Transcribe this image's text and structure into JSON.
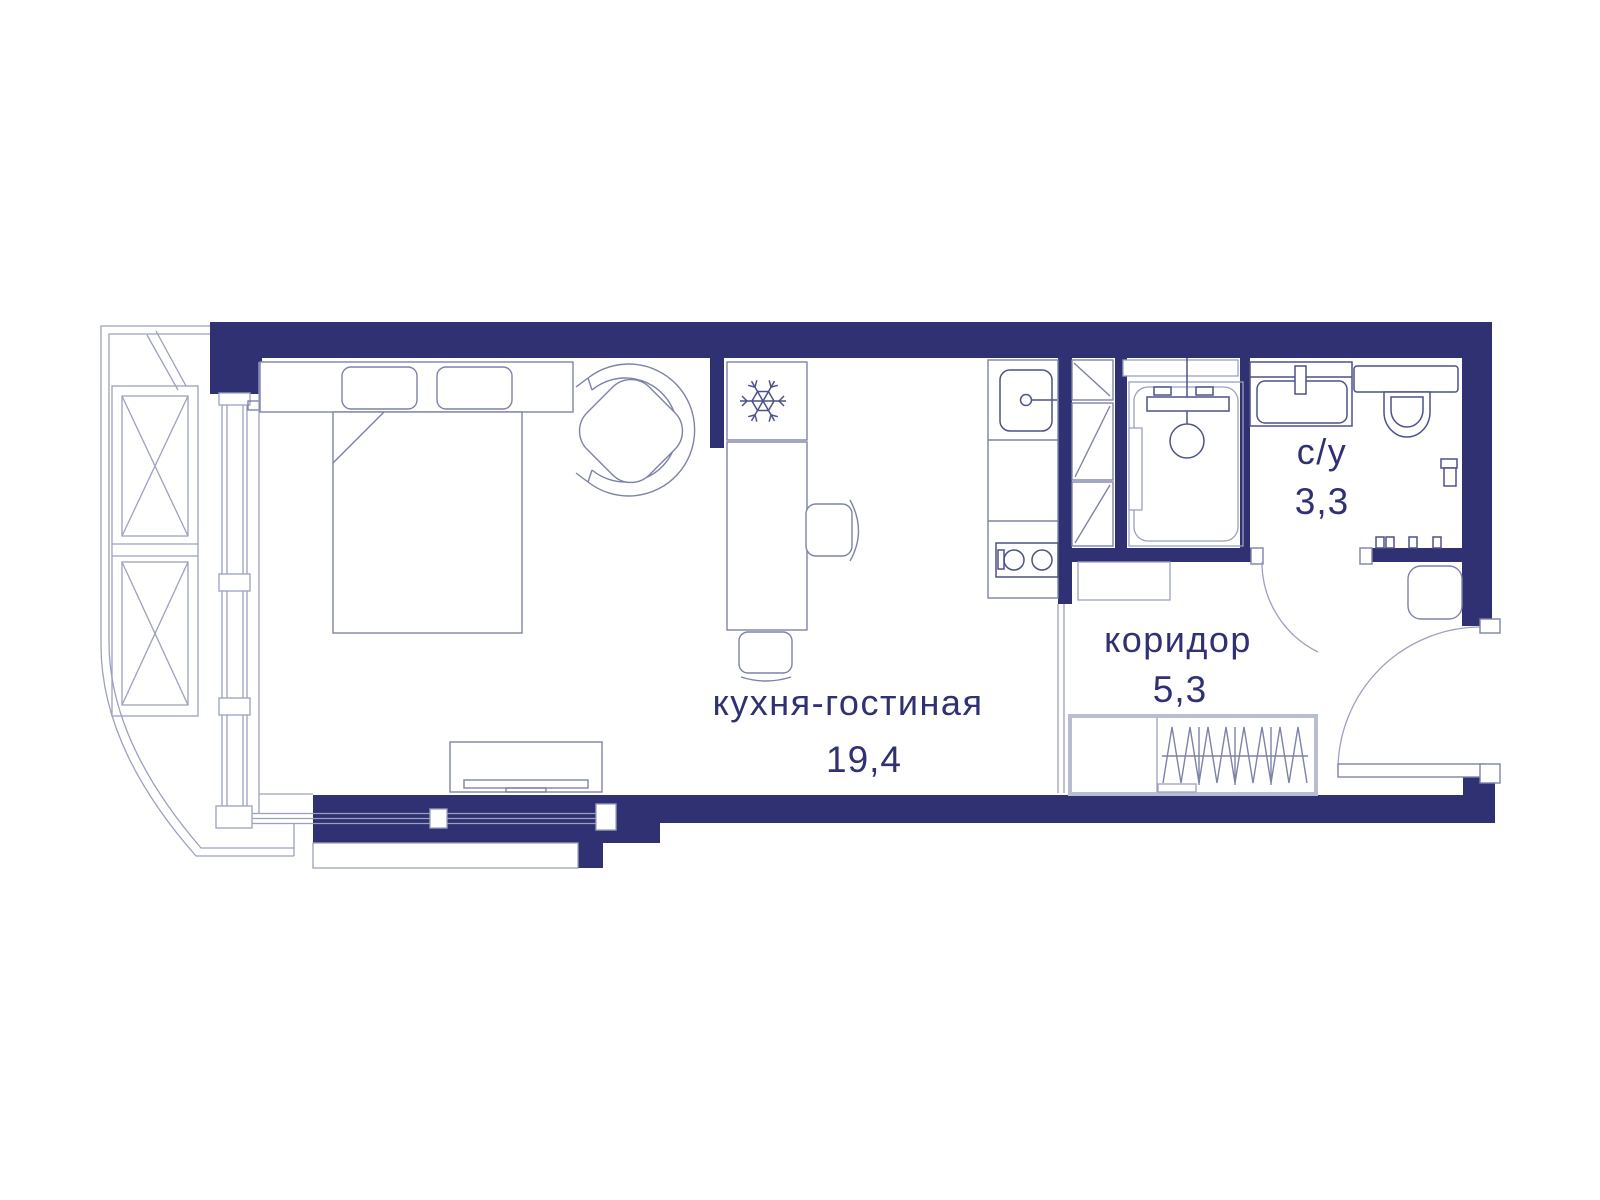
{
  "plan": {
    "title": "studio apartment floor plan",
    "rooms": [
      {
        "name": "кухня-гостиная",
        "area": "19,4"
      },
      {
        "name": "коридор",
        "area": "5,3"
      },
      {
        "name": "с/у",
        "area": "3,3"
      }
    ],
    "colors": {
      "wall": "#2f3172",
      "text": "#2f3172",
      "line_light": "#9ba0bf",
      "line_mid": "#7d82a8",
      "fixture": "#4d5288",
      "wardrobe": "#b9bdd2",
      "bg": "#ffffff"
    }
  }
}
